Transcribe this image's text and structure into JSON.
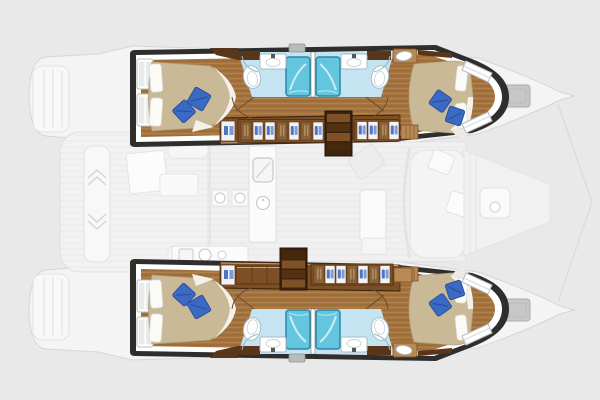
{
  "colors": {
    "bg": "#e9e9e9",
    "ghost-fill": "#f4f4f4",
    "ghost-stroke": "#d6d6d6",
    "frame": "#2f2e2c",
    "wood": "#a5743f",
    "wood-dark": "#7c4f24",
    "wood-deep": "#59351a",
    "bedtan": "#c9b997",
    "pillow-blue": "#3b6ac4",
    "bath-floor": "#c3e4f0",
    "shower": "#64c5de",
    "shower-frame": "#2f85a6",
    "icon-blue": "#4f74c8"
  },
  "floor_plan": {
    "type": "catamaran-yacht-interior-layout",
    "hulls": [
      {
        "side": "port-top",
        "rooms": [
          "aft-double-cabin",
          "aft-bathroom",
          "forward-bathroom",
          "forward-double-cabin"
        ],
        "fixtures": {
          "showers": 2,
          "toilets": 2,
          "sinks": 2,
          "blue-pillows": 4,
          "hull-windows": 4
        },
        "features": [
          "companionway-stairs",
          "wardrobe-lockers"
        ]
      },
      {
        "side": "starboard-bottom",
        "rooms": [
          "aft-double-cabin",
          "aft-bathroom",
          "forward-bathroom",
          "forward-double-cabin"
        ],
        "fixtures": {
          "showers": 2,
          "toilets": 2,
          "sinks": 2,
          "blue-pillows": 4,
          "hull-windows": 4
        },
        "features": [
          "companionway-stairs",
          "wardrobe-lockers"
        ]
      }
    ],
    "center_deck_faint": [
      "stern-swim-platforms",
      "aft-cockpit",
      "salon-and-galley",
      "foredeck",
      "bow-hatches"
    ],
    "counts": {
      "cabins": 4,
      "bathrooms": 4,
      "staircases": 2
    }
  }
}
